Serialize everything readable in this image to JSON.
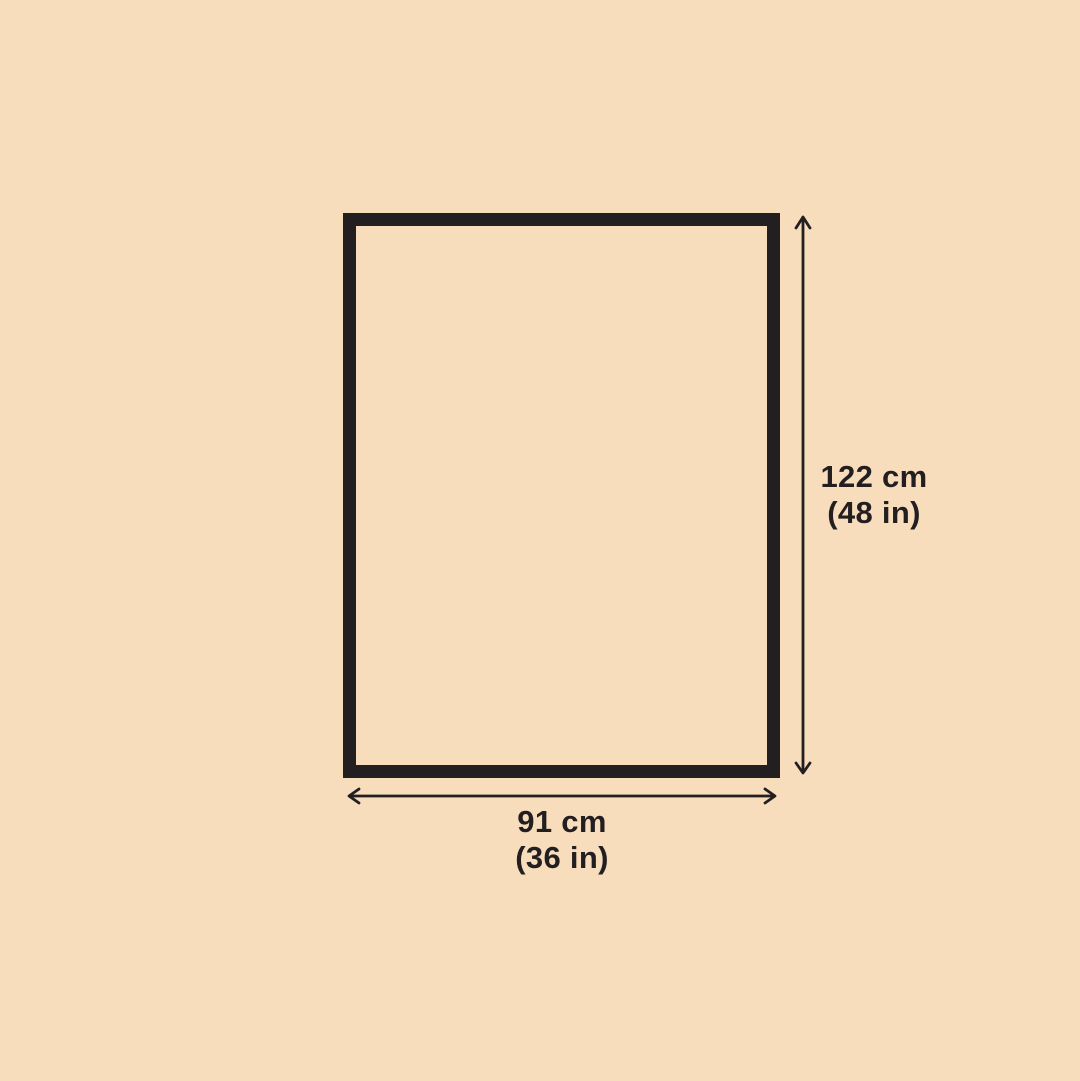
{
  "colors": {
    "background_color": "#f7ddbc",
    "outline_color": "#231f20"
  },
  "diagram": {
    "shape": "rectangle",
    "height_label_line1": "122 cm",
    "height_label_line2": "(48 in)",
    "width_label_line1": "91 cm",
    "width_label_line2": "(36 in)"
  }
}
